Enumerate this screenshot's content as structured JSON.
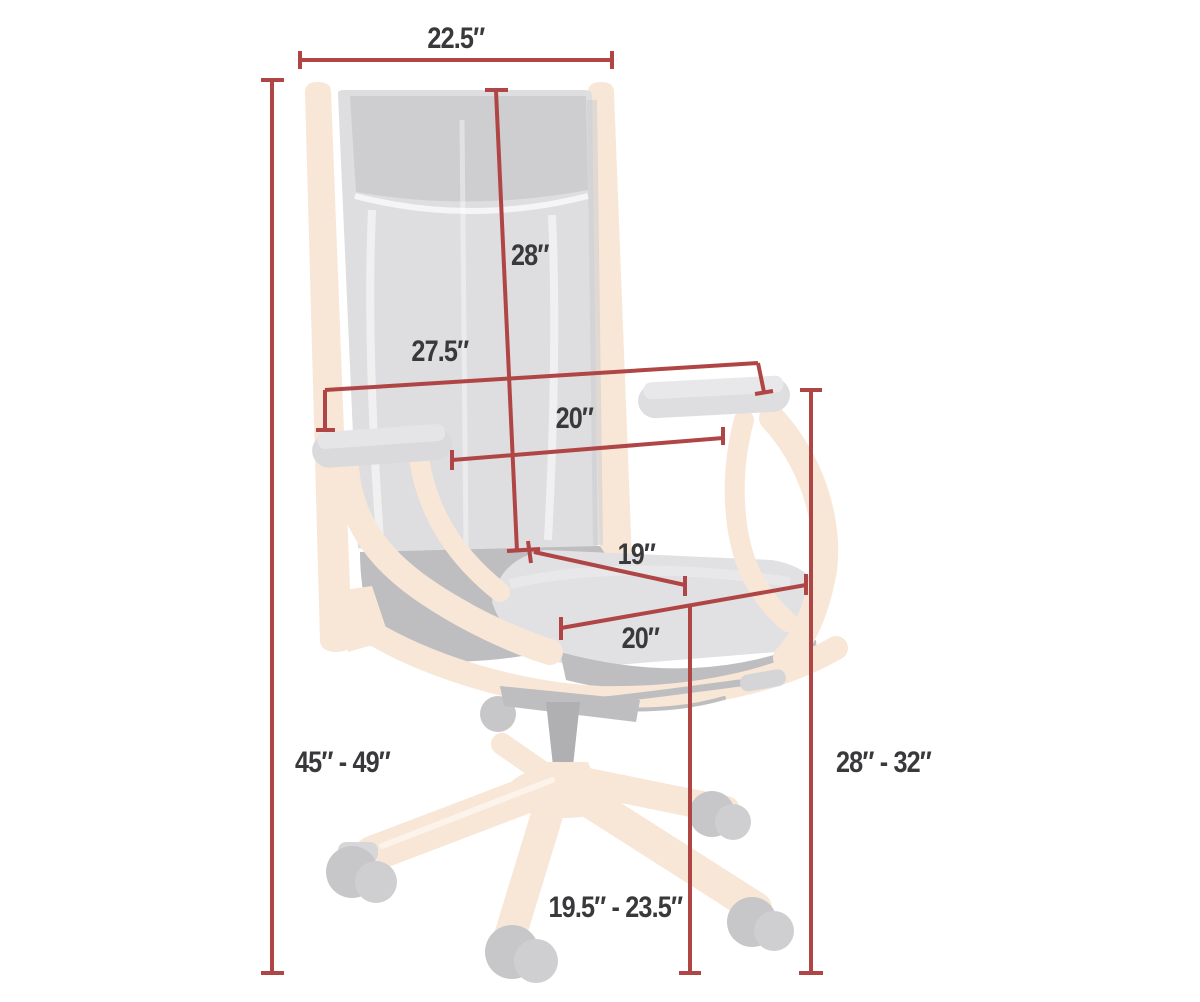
{
  "diagram": {
    "kind": "chair-dimension-diagram",
    "subject": "high-back wooden desk chair (ghosted illustration)",
    "colors": {
      "dimension_line": "#b04545",
      "label_text": "#39393b",
      "wood": "#f8e7d7",
      "upholstery": "#dedee0",
      "background": "#ffffff"
    },
    "measurements": {
      "back_width": "22.5″",
      "back_height": "28″",
      "overall_arm_width": "27.5″",
      "width_between_arms": "20″",
      "seat_depth": "19″",
      "seat_width": "20″",
      "overall_height": "45″ - 49″",
      "arm_height": "28″ - 32″",
      "seat_height": "19.5″ - 23.5″"
    }
  }
}
